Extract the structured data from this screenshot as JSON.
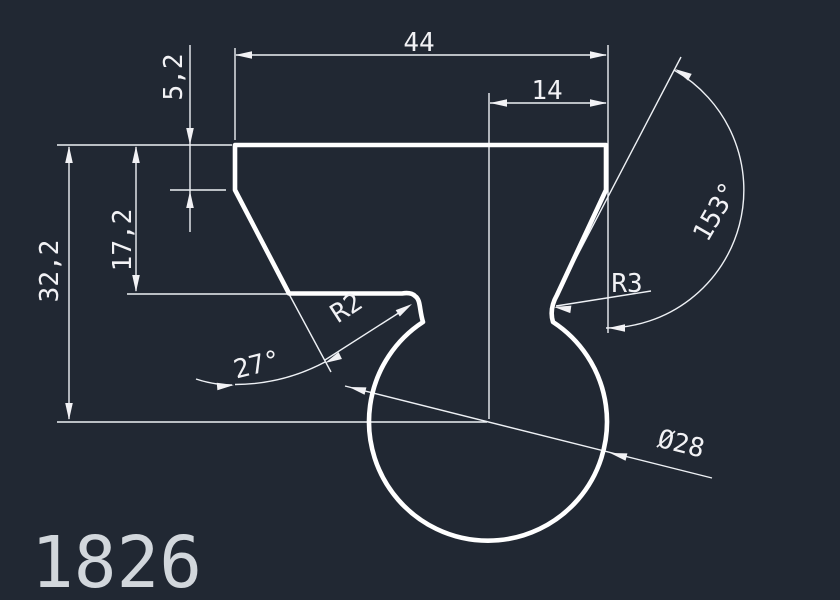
{
  "drawing": {
    "part_number": "1826",
    "colors": {
      "background": "#212833",
      "geometry": "#ffffff",
      "dimension": "#f2f2f5",
      "part_number_label": "#d2d7dc"
    },
    "dimensions": {
      "top_width": "44",
      "upper_right_width": "14",
      "neck_height": "5,2",
      "shoulder_height": "17,2",
      "total_height": "32,2",
      "left_angle": "27°",
      "right_angle": "153°",
      "tip_radius": "R2",
      "notch_radius": "R3",
      "circle_diameter": "Ø28"
    }
  }
}
